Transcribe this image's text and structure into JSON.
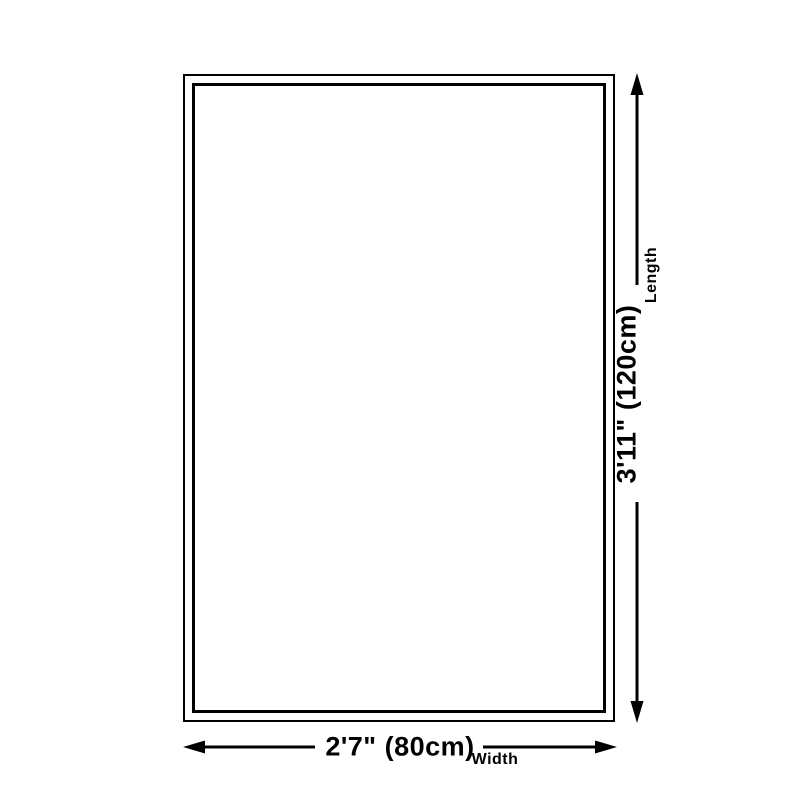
{
  "diagram": {
    "type": "product-dimension-diagram",
    "background_color": "#ffffff",
    "line_color": "#000000",
    "length_dimension": {
      "value": "3'11\" (120cm)",
      "label": "Length"
    },
    "width_dimension": {
      "value": "2'7\" (80cm)",
      "label": "Width"
    }
  }
}
